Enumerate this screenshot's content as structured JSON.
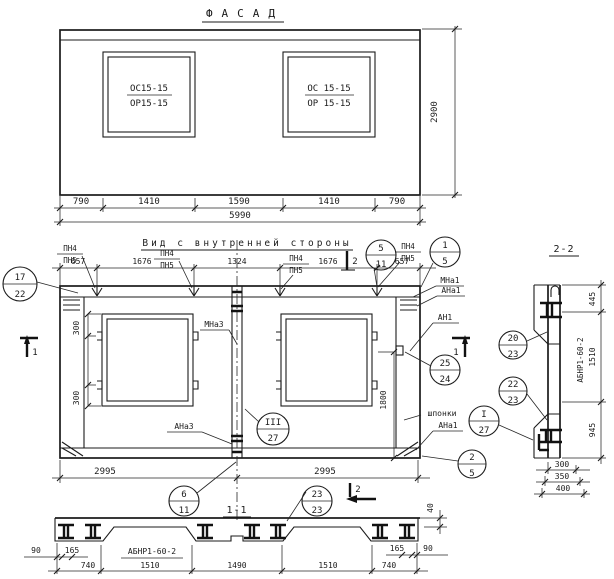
{
  "facade": {
    "title": "ФАСАД",
    "win_left_top": "ОС15-15",
    "win_left_bot": "ОР15-15",
    "win_right_top": "ОС 15-15",
    "win_right_bot": "ОР 15-15",
    "dims": [
      "790",
      "1410",
      "1590",
      "1410",
      "790"
    ],
    "total": "5990",
    "height": "2900"
  },
  "inner": {
    "title": "Вид с внутренней стороны",
    "dims": [
      "657",
      "1676",
      "1324",
      "1676",
      "657"
    ],
    "pn_top": "ПН4",
    "pn_bot": "ПН5",
    "dim300": "300",
    "dim1800": "1800",
    "span_left": "2995",
    "span_right": "2995",
    "mna3": "МНа3",
    "ana3": "АНа3",
    "mna1": "МНа1",
    "ana1": "АНа1",
    "an1": "АН1",
    "shponki": "шпонки",
    "ana1b": "АНа1"
  },
  "sec11": {
    "title": "1-1",
    "label": "АБНР1-60-2",
    "d90": "90",
    "d165": "165",
    "d40": "40",
    "dims": [
      "740",
      "1510",
      "1490",
      "1510",
      "740"
    ]
  },
  "sec22": {
    "title": "2-2",
    "label": "АБНР1-60-2",
    "dims_v": [
      "445",
      "1510",
      "945"
    ],
    "dims_b": [
      "300",
      "350",
      "400"
    ]
  },
  "marks": {
    "m1": "1",
    "m2": "2"
  },
  "callouts": [
    {
      "top": "17",
      "bot": "22"
    },
    {
      "top": "5",
      "bot": "11"
    },
    {
      "top": "1",
      "bot": "5"
    },
    {
      "top": "25",
      "bot": "24"
    },
    {
      "top": "20",
      "bot": "23"
    },
    {
      "top": "22",
      "bot": "23"
    },
    {
      "top": "I",
      "bot": "27"
    },
    {
      "top": "III",
      "bot": "27"
    },
    {
      "top": "2",
      "bot": "5"
    },
    {
      "top": "6",
      "bot": "11"
    },
    {
      "top": "23",
      "bot": "23"
    }
  ]
}
